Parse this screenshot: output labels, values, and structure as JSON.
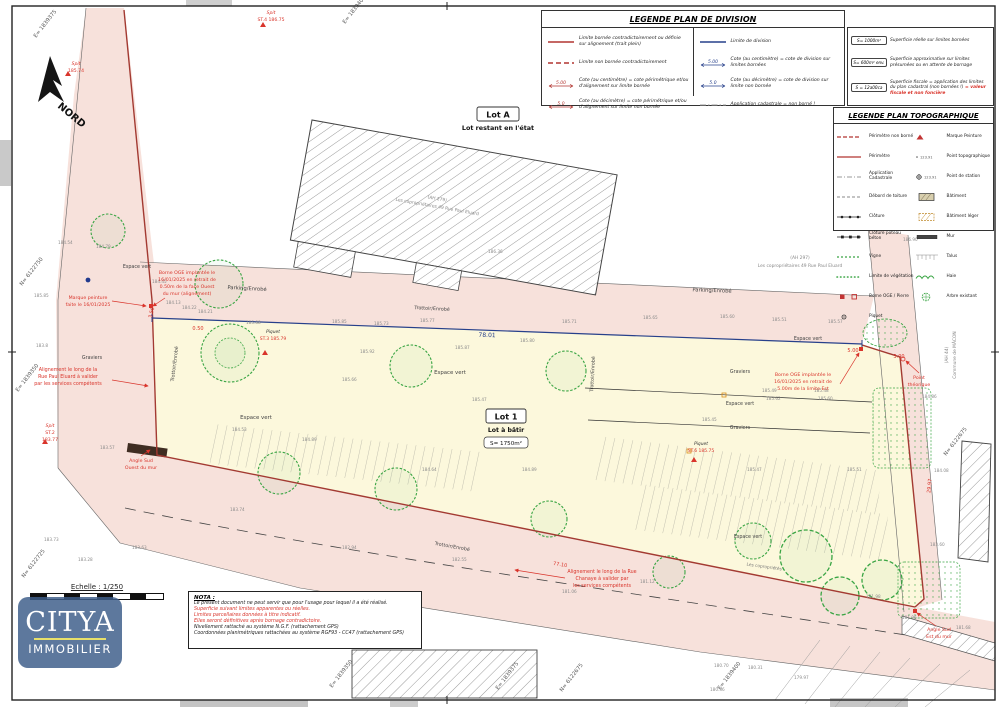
{
  "legend_division": {
    "title": "LEGENDE PLAN DE DIVISION",
    "col1": [
      {
        "sym": "red-solid",
        "text": "Limite bornée contradictoirement ou définie sur alignement (trait plein)"
      },
      {
        "sym": "red-dash",
        "text": "Limite non bornée contradictoirement"
      },
      {
        "sym": "cote-red",
        "v": "5.00",
        "text": "Cote (au centimètre) = cote périmétrique et/ou d'alignement sur limite bornée"
      },
      {
        "sym": "cote-red",
        "v": "5.0",
        "text": "Cote (au décimètre) = cote périmétrique et/ou d'alignement sur limite non bornée"
      }
    ],
    "col2": [
      {
        "sym": "blue-solid",
        "text": "Limite de division"
      },
      {
        "sym": "cote-blue",
        "v": "5.00",
        "text": "Cote (au centimètre) = cote de division sur limites bornées"
      },
      {
        "sym": "cote-blue",
        "v": "5.0",
        "text": "Cote (au décimètre) = cote de division sur limite non bornée"
      },
      {
        "sym": "gray-dashdot",
        "text": "Application cadastrale = non borné !"
      }
    ],
    "col3": [
      {
        "box": "S= 1000m²",
        "text": "Superficie réelle sur limites bornées",
        "text_red": ""
      },
      {
        "box": "S= 600m² env.",
        "text": "Superficie approximative sur limites présumées ou en attente de bornage",
        "text_red": ""
      },
      {
        "box": "S = 12a00ca",
        "text": "Superficie fiscale = application des limites du plan cadastral (non bornées !)",
        "text_red": "= valeur fiscale et non foncière"
      }
    ]
  },
  "legend_topo": {
    "title": "LEGENDE PLAN TOPOGRAPHIQUE",
    "left": [
      {
        "sym": "t-perim-nb",
        "text": "Périmètre non borné"
      },
      {
        "sym": "t-perim",
        "text": "Périmètre"
      },
      {
        "sym": "t-cad",
        "text": "Application Cadastrale"
      },
      {
        "sym": "t-toit",
        "text": "Débord de toiture"
      },
      {
        "sym": "t-clot",
        "text": "Clôture"
      },
      {
        "sym": "t-clot-pb",
        "text": "Clôture poteau béton"
      },
      {
        "sym": "t-vigne",
        "text": "Vigne"
      },
      {
        "sym": "t-veg",
        "text": "Limite de végétation"
      },
      {
        "sym": "t-borne",
        "text": "Borne OGE / Pierre"
      },
      {
        "sym": "t-piquet",
        "text": "Piquet"
      }
    ],
    "right": [
      {
        "sym": "t-marque",
        "text": "Marque Peinture"
      },
      {
        "sym": "t-ptopo",
        "text": "Point topographique"
      },
      {
        "sym": "t-pstation",
        "text": "Point de station"
      },
      {
        "sym": "t-bat",
        "text": "Bâtiment"
      },
      {
        "sym": "t-bat-leger",
        "text": "Bâtiment léger"
      },
      {
        "sym": "t-mur",
        "text": "Mur"
      },
      {
        "sym": "t-talus",
        "text": "Talus"
      },
      {
        "sym": "t-haie",
        "text": "Haie"
      },
      {
        "sym": "t-arbre",
        "text": "Arbre existant"
      }
    ]
  },
  "lots": {
    "a": {
      "title": "Lot A",
      "subtitle": "Lot restant en l'état"
    },
    "b": {
      "title": "Lot 1",
      "subtitle": "Lot à bâtir",
      "area": "S= 1750m²"
    }
  },
  "nota": {
    "title": "NOTA :",
    "lines": [
      {
        "text": "Le présent document ne peut servir que pour l'usage pour lequel il a été réalisé.",
        "color": "#222222"
      },
      {
        "text": "Superficie suivant limites apparentes ou réelles.",
        "color": "#d9342b"
      },
      {
        "text": "Limites parcellaires données à titre indicatif.",
        "color": "#d9342b"
      },
      {
        "text": "Elles seront définitives après bornage contradictoire.",
        "color": "#d9342b"
      },
      {
        "text": "Nivellement rattaché au système N.G.F. (rattachement GPS)",
        "color": "#222222"
      },
      {
        "text": "Coordonnées planimétriques rattachées au système RGF93 - CC47 (rattachement GPS)",
        "color": "#222222"
      }
    ]
  },
  "scalebar": {
    "label": "Echelle : 1/250"
  },
  "logo": {
    "name": "CITYA",
    "sub": "IMMOBILIER"
  },
  "north": {
    "label": "NORD"
  },
  "colors": {
    "accent_red": "#d9342b",
    "perimeter": "#a33a32",
    "division_blue": "#27408b",
    "road_pink": "#f7e1db",
    "parcel_yellow": "#fcf8dc",
    "green": "#3aa544"
  },
  "map": {
    "labels": [
      {
        "t": "Parking/Enrobé",
        "x": 247,
        "y": 290,
        "r": 3,
        "s": 5.2,
        "c": "#444444"
      },
      {
        "t": "Parking/Enrobé",
        "x": 712,
        "y": 292,
        "r": 2,
        "s": 5.2,
        "c": "#444444"
      },
      {
        "t": "Trottoir/Enrobé",
        "x": 432,
        "y": 310,
        "r": 3,
        "s": 4.8,
        "c": "#444444"
      },
      {
        "t": "Trottoir/Enrobé",
        "x": 176,
        "y": 364,
        "r": -83,
        "s": 4.8,
        "c": "#444444"
      },
      {
        "t": "Trottoir/Enrobé",
        "x": 594,
        "y": 374,
        "r": -87,
        "s": 4.8,
        "c": "#444444"
      },
      {
        "t": "Trottoir/Enrobé",
        "x": 452,
        "y": 548,
        "r": 10,
        "s": 4.8,
        "c": "#444444"
      },
      {
        "t": "Espace vert",
        "x": 137,
        "y": 268,
        "s": 4.8,
        "c": "#444444"
      },
      {
        "t": "Espace vert",
        "x": 450,
        "y": 374,
        "s": 5.4,
        "c": "#444444"
      },
      {
        "t": "Espace vert",
        "x": 256,
        "y": 419,
        "s": 5.4,
        "c": "#444444"
      },
      {
        "t": "Espace vert",
        "x": 808,
        "y": 340,
        "s": 4.8,
        "c": "#444444"
      },
      {
        "t": "Espace vert",
        "x": 740,
        "y": 405,
        "s": 4.8,
        "c": "#444444"
      },
      {
        "t": "Espace vert",
        "x": 748,
        "y": 538,
        "s": 4.8,
        "c": "#444444"
      },
      {
        "t": "Graviers",
        "x": 92,
        "y": 359,
        "s": 4.8,
        "c": "#444444"
      },
      {
        "t": "Graviers",
        "x": 740,
        "y": 373,
        "s": 4.8,
        "c": "#444444"
      },
      {
        "t": "Graviers",
        "x": 740,
        "y": 429,
        "s": 4.8,
        "c": "#444444"
      },
      {
        "t": "Les copropriétés",
        "x": 764,
        "y": 568,
        "r": 8,
        "s": 4.3,
        "c": "#777777"
      },
      {
        "t": "(AH 279)",
        "x": 437,
        "y": 200,
        "r": 10,
        "s": 4.4,
        "c": "#888888"
      },
      {
        "t": "Les copropriétaires 49 Rue Paul Eluard",
        "x": 437,
        "y": 208,
        "r": 10,
        "s": 4.4,
        "c": "#888888"
      },
      {
        "t": "(AH 297)",
        "x": 800,
        "y": 259,
        "s": 4.4,
        "c": "#888888"
      },
      {
        "t": "Les copropriétaires 49 Rue Paul Eluard",
        "x": 800,
        "y": 267,
        "s": 4.4,
        "c": "#888888"
      },
      {
        "t": "(AH 44)",
        "x": 948,
        "y": 355,
        "r": -90,
        "s": 4.4,
        "c": "#888888"
      },
      {
        "t": "Commune de MÂCON",
        "x": 956,
        "y": 355,
        "r": -90,
        "s": 4.4,
        "c": "#888888"
      },
      {
        "t": "Marque peinture",
        "x": 88,
        "y": 299,
        "s": 4.7,
        "c": "#d9342b"
      },
      {
        "t": "faite le 16/01/2025",
        "x": 88,
        "y": 306,
        "s": 4.7,
        "c": "#d9342b"
      },
      {
        "t": "Borne OGE implantée le",
        "x": 187,
        "y": 274,
        "s": 4.7,
        "c": "#d9342b"
      },
      {
        "t": "16/01/2025 en retrait de",
        "x": 187,
        "y": 281,
        "s": 4.7,
        "c": "#d9342b"
      },
      {
        "t": "0.50m de la face Ouest",
        "x": 187,
        "y": 288,
        "s": 4.7,
        "c": "#d9342b"
      },
      {
        "t": "du mur (alignement)",
        "x": 187,
        "y": 295,
        "s": 4.7,
        "c": "#d9342b"
      },
      {
        "t": "Alignement le long de la",
        "x": 68,
        "y": 371,
        "s": 4.8,
        "c": "#d9342b"
      },
      {
        "t": "Rue Paul Eluard à valider",
        "x": 68,
        "y": 378,
        "s": 4.8,
        "c": "#d9342b"
      },
      {
        "t": "par les services compétents",
        "x": 68,
        "y": 385,
        "s": 4.8,
        "c": "#d9342b"
      },
      {
        "t": "Angle Sud",
        "x": 141,
        "y": 462,
        "s": 4.7,
        "c": "#d9342b"
      },
      {
        "t": "Ouest du mur",
        "x": 141,
        "y": 469,
        "s": 4.7,
        "c": "#d9342b"
      },
      {
        "t": "Borne OGE implantée le",
        "x": 803,
        "y": 376,
        "s": 4.7,
        "c": "#d9342b"
      },
      {
        "t": "16/01/2025 en retrait de",
        "x": 803,
        "y": 383,
        "s": 4.7,
        "c": "#d9342b"
      },
      {
        "t": "5.00m de la limite Est",
        "x": 803,
        "y": 390,
        "s": 4.7,
        "c": "#d9342b"
      },
      {
        "t": "Point",
        "x": 919,
        "y": 379,
        "s": 4.7,
        "c": "#d9342b"
      },
      {
        "t": "théorique",
        "x": 919,
        "y": 386,
        "s": 4.7,
        "c": "#d9342b"
      },
      {
        "t": "Alignement le long de la Rue",
        "x": 602,
        "y": 573,
        "s": 4.8,
        "c": "#d9342b"
      },
      {
        "t": "Chanaye à valider par",
        "x": 602,
        "y": 580,
        "s": 4.8,
        "c": "#d9342b"
      },
      {
        "t": "les services compétents",
        "x": 602,
        "y": 587,
        "s": 4.8,
        "c": "#d9342b"
      },
      {
        "t": "Angle Sud",
        "x": 939,
        "y": 631,
        "s": 4.7,
        "c": "#d9342b"
      },
      {
        "t": "Est du mur",
        "x": 939,
        "y": 638,
        "s": 4.7,
        "c": "#d9342b"
      },
      {
        "t": "Spit",
        "x": 271,
        "y": 14,
        "s": 4.6,
        "c": "#d9342b",
        "fi": 1
      },
      {
        "t": "ST.4 186.75",
        "x": 271,
        "y": 21,
        "s": 4.6,
        "c": "#d9342b"
      },
      {
        "t": "Spit",
        "x": 76,
        "y": 65,
        "s": 4.6,
        "c": "#d9342b",
        "fi": 1
      },
      {
        "t": "185.74",
        "x": 76,
        "y": 72,
        "s": 4.6,
        "c": "#d9342b"
      },
      {
        "t": "Spit",
        "x": 50,
        "y": 427,
        "s": 4.6,
        "c": "#d9342b",
        "fi": 1
      },
      {
        "t": "ST.2",
        "x": 50,
        "y": 434,
        "s": 4.6,
        "c": "#d9342b"
      },
      {
        "t": "183.77",
        "x": 50,
        "y": 441,
        "s": 4.6,
        "c": "#d9342b"
      },
      {
        "t": "Piquet",
        "x": 273,
        "y": 333,
        "s": 4.4,
        "c": "#333333",
        "fi": 1
      },
      {
        "t": "ST.3 185.79",
        "x": 273,
        "y": 340,
        "s": 4.5,
        "c": "#d9342b"
      },
      {
        "t": "Piquet",
        "x": 701,
        "y": 445,
        "s": 4.4,
        "c": "#333333",
        "fi": 1
      },
      {
        "t": "ST.6 185.75",
        "x": 701,
        "y": 452,
        "s": 4.5,
        "c": "#d9342b"
      },
      {
        "t": "78.01",
        "x": 487,
        "y": 337,
        "r": 2,
        "s": 6,
        "c": "#27408b"
      },
      {
        "t": "3.50",
        "x": 153,
        "y": 313,
        "r": -75,
        "s": 5,
        "c": "#d9342b"
      },
      {
        "t": "0.50",
        "x": 198,
        "y": 330,
        "s": 5,
        "c": "#d9342b"
      },
      {
        "t": "5.00",
        "x": 853,
        "y": 352,
        "s": 5,
        "c": "#d9342b"
      },
      {
        "t": "3.00",
        "x": 899,
        "y": 358,
        "s": 5,
        "c": "#d9342b"
      },
      {
        "t": "29.97",
        "x": 931,
        "y": 486,
        "r": -84,
        "s": 5,
        "c": "#d9342b"
      },
      {
        "t": "77.10",
        "x": 560,
        "y": 566,
        "r": 9,
        "s": 5,
        "c": "#d9342b"
      }
    ],
    "grid": [
      [
        "E= 1839375",
        36,
        38
      ],
      [
        "E= 1839400",
        345,
        24
      ],
      [
        "N= 6122750",
        22,
        286
      ],
      [
        "E= 1839350",
        18,
        392
      ],
      [
        "N= 6122725",
        24,
        578
      ],
      [
        "E= 1839350",
        332,
        688
      ],
      [
        "E= 1839375",
        498,
        690
      ],
      [
        "N= 6122675",
        562,
        692
      ],
      [
        "E= 1839400",
        720,
        690
      ],
      [
        "N= 6122675",
        946,
        456
      ]
    ],
    "elev": [
      [
        "184.54",
        58,
        244
      ],
      [
        "184.79",
        96,
        248
      ],
      [
        "185.85",
        34,
        297
      ],
      [
        "184.45",
        152,
        283
      ],
      [
        "184.13",
        166,
        304
      ],
      [
        "184.22",
        182,
        309
      ],
      [
        "184.21",
        198,
        313
      ],
      [
        "183.8",
        36,
        347
      ],
      [
        "183.57",
        100,
        449
      ],
      [
        "185.88",
        246,
        324
      ],
      [
        "185.85",
        332,
        323
      ],
      [
        "185.73",
        374,
        325
      ],
      [
        "185.77",
        420,
        322
      ],
      [
        "185.71",
        562,
        323
      ],
      [
        "185.65",
        643,
        319
      ],
      [
        "185.60",
        720,
        318
      ],
      [
        "185.51",
        772,
        321
      ],
      [
        "185.57",
        828,
        323
      ],
      [
        "186.90",
        903,
        241
      ],
      [
        "186.36",
        488,
        253
      ],
      [
        "185.87",
        455,
        349
      ],
      [
        "185.92",
        360,
        353
      ],
      [
        "185.80",
        520,
        342
      ],
      [
        "185.66",
        342,
        381
      ],
      [
        "185.47",
        472,
        401
      ],
      [
        "185.49",
        762,
        392
      ],
      [
        "185.62",
        766,
        400
      ],
      [
        "185.48",
        814,
        392
      ],
      [
        "185.60",
        818,
        400
      ],
      [
        "185.45",
        702,
        421
      ],
      [
        "185.47",
        747,
        471
      ],
      [
        "185.51",
        847,
        471
      ],
      [
        "184.89",
        522,
        471
      ],
      [
        "184.64",
        422,
        471
      ],
      [
        "184.89",
        302,
        441
      ],
      [
        "184.53",
        232,
        431
      ],
      [
        "183.73",
        44,
        541
      ],
      [
        "183.63",
        132,
        549
      ],
      [
        "183.28",
        78,
        561
      ],
      [
        "183.74",
        230,
        511
      ],
      [
        "182.94",
        342,
        549
      ],
      [
        "182.55",
        452,
        561
      ],
      [
        "181.06",
        562,
        593
      ],
      [
        "181.12",
        640,
        583
      ],
      [
        "180.70",
        714,
        667
      ],
      [
        "180.31",
        748,
        669
      ],
      [
        "180.36",
        710,
        691
      ],
      [
        "179.97",
        794,
        679
      ],
      [
        "181.96",
        902,
        619
      ],
      [
        "181.68",
        956,
        629
      ],
      [
        "181.98",
        866,
        598
      ],
      [
        "183.60",
        930,
        546
      ],
      [
        "184.08",
        934,
        472
      ],
      [
        "184.86",
        922,
        398
      ]
    ]
  }
}
